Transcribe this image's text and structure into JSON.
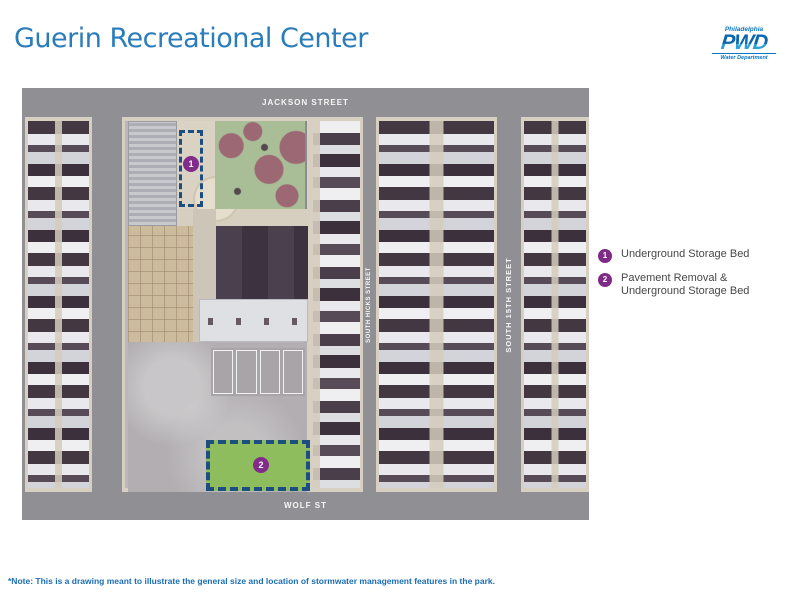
{
  "page": {
    "title": "Guerin Recreational Center",
    "note": "*Note: This is a drawing meant to illustrate the general size and location of stormwater management features in the park."
  },
  "logo": {
    "city": "Philadelphia",
    "acronym": "PWD",
    "department": "Water Department"
  },
  "map": {
    "street_top": "JACKSON STREET",
    "street_bottom": "WOLF ST",
    "street_left": "SOUTH 16TH STREET",
    "street_middle": "SOUTH HICKS STREET",
    "street_right": "SOUTH 15TH STREET",
    "markers": [
      {
        "number": "1"
      },
      {
        "number": "2"
      }
    ]
  },
  "legend": {
    "items": [
      {
        "number": "1",
        "lines": [
          "Underground Storage Bed",
          ""
        ]
      },
      {
        "number": "2",
        "lines": [
          "Pavement Removal &",
          "Underground Storage Bed"
        ]
      }
    ]
  },
  "colors": {
    "title_blue": "#2b7cba",
    "logo_blue": "#0b77c2",
    "street_gray": "#909094",
    "marker_purple": "#7d2b85",
    "feature_green": "#8ebd5e",
    "feature_outline_navy": "#1d4e7f",
    "note_blue": "#1b6db3"
  }
}
